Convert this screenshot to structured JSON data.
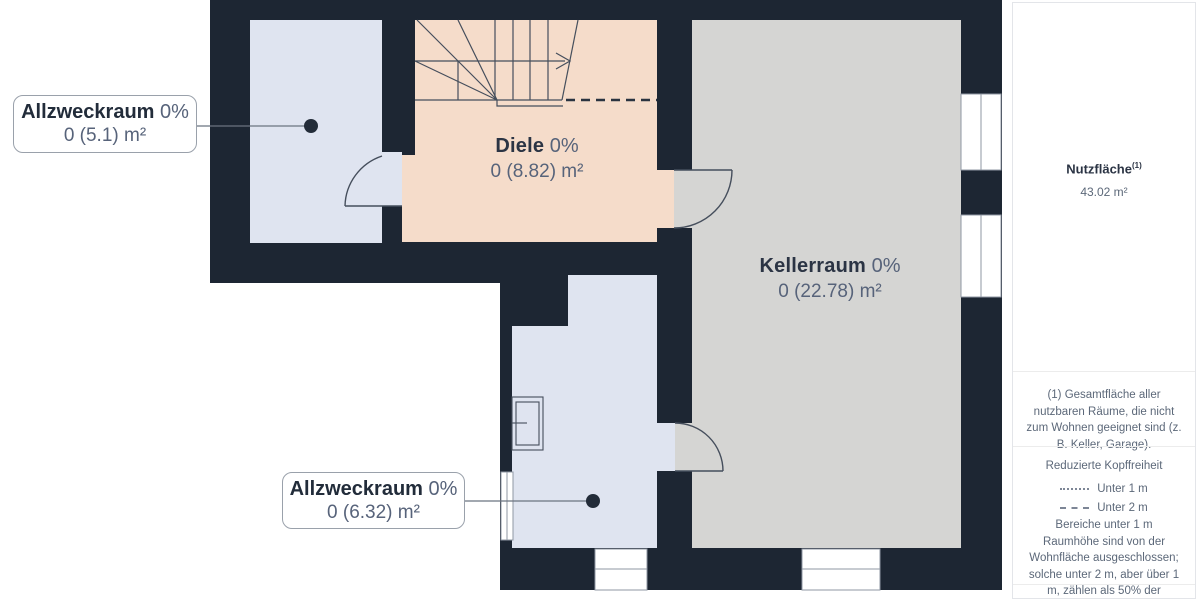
{
  "plan": {
    "colors": {
      "wall": "#1d2633",
      "room_blue": "#dfe4f0",
      "room_peach": "#f5dcca",
      "room_gray": "#d5d5d3",
      "plan_line": "#454e5c",
      "dash_line": "#2a3340",
      "callout_line": "#6b7380",
      "dot": "#232c39"
    },
    "room_labels": [
      {
        "name": "Diele",
        "percent": "0%",
        "value": "0 (8.82) m²"
      },
      {
        "name": "Kellerraum",
        "percent": "0%",
        "value": "0 (22.78) m²"
      }
    ],
    "callouts": [
      {
        "name": "Allzweckraum",
        "percent": "0%",
        "value": "0 (5.1) m²"
      },
      {
        "name": "Allzweckraum",
        "percent": "0%",
        "value": "0 (6.32) m²"
      }
    ]
  },
  "sidebar": {
    "area_title": "Nutzfläche",
    "area_superscript": "(1)",
    "area_value": "43.02 m²",
    "footnote": "(1) Gesamtfläche aller nutzbaren Räume, die nicht zum Wohnen geeignet sind (z. B. Keller, Garage).",
    "legend_title": "Reduzierte Kopffreiheit",
    "legend_items": [
      {
        "style": "dotted",
        "label": "Unter 1 m"
      },
      {
        "style": "dashed",
        "label": "Unter 2 m"
      }
    ],
    "legend_note": "Bereiche unter 1 m Raumhöhe sind von der Wohnfläche ausgeschlossen; solche unter 2 m, aber über 1 m, zählen als 50% der Wohnfläche"
  }
}
